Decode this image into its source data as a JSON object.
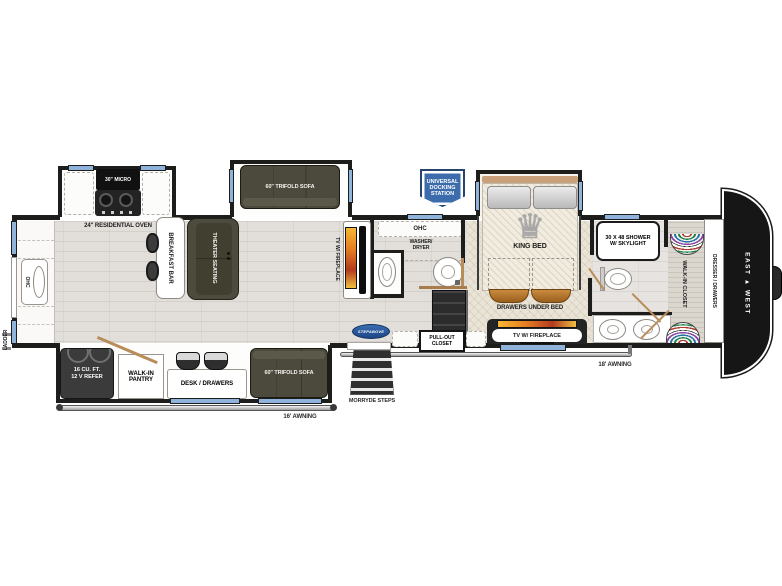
{
  "title": "fifth-wheel floor plan",
  "colors": {
    "wall": "#1d1d1b",
    "window_blue": "#8fb3da",
    "sofa_olive": "#4c4a3d",
    "flame_orange": "#e67e22",
    "badge_blue": "#3c6cac",
    "wood_trim": "#b5772f",
    "floor": "#e2dfdb",
    "carpet": "#eae4d7"
  },
  "exterior": {
    "front_cap_logo": "EAST ▲ WEST",
    "awning_left": "16' AWNING",
    "awning_right": "18' AWNING",
    "steps_label": "MORRYDE STEPS",
    "step_above_logo": "STEPABOVE",
    "ladder": "LADDER",
    "docking_station": [
      "UNIVERSAL",
      "DOCKING",
      "STATION"
    ]
  },
  "kitchen": {
    "micro": "30\" MICRO",
    "oven": "24\" RESIDENTIAL OVEN",
    "breakfast_bar": "BREAKFAST BAR",
    "rear_cabinet": "OHC"
  },
  "living": {
    "theater_seating": "THEATER SEATING",
    "trifold_sofa": "60\" TRIFOLD SOFA",
    "tv_fireplace": "TV W/ FIREPLACE"
  },
  "laundry": {
    "cabinet": "OHC",
    "washer_dryer": [
      "WASHER/",
      "DRYER"
    ]
  },
  "hall": {
    "pullout_closet": [
      "PULL-OUT",
      "CLOSET"
    ]
  },
  "bedroom": {
    "king_bed": "KING BED",
    "drawers_under_bed": "DRAWERS UNDER BED",
    "tv_fireplace": "TV W/ FIREPLACE"
  },
  "bathroom": {
    "shower": [
      "30 X 48 SHOWER",
      "W/ SKYLIGHT"
    ],
    "walk_in_closet": "WALK-IN CLOSET",
    "dresser": "DRESSER / DRAWERS"
  },
  "lower_slide": {
    "refrigerator": [
      "16 CU. FT.",
      "12 V REFER"
    ],
    "pantry": [
      "WALK-IN",
      "PANTRY"
    ],
    "desk": "DESK / DRAWERS",
    "trifold_sofa": "60\" TRIFOLD SOFA"
  }
}
